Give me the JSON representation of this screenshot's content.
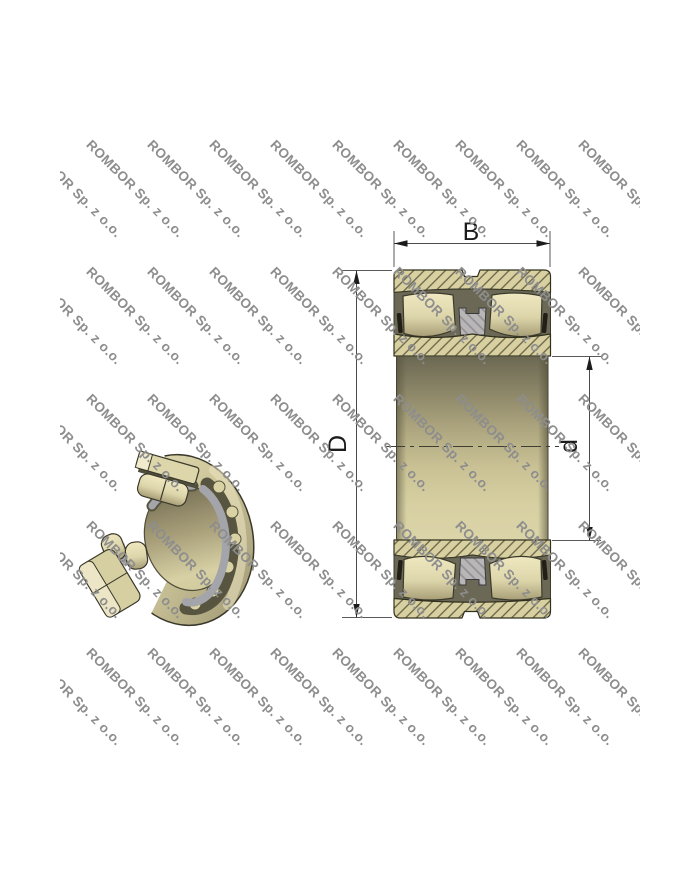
{
  "watermark": {
    "text": "ROMBOR Sp. z o.o.",
    "color": "#8d8d8d",
    "rows": 5,
    "cols": 10
  },
  "section": {
    "dim_labels": {
      "width": "B",
      "outer_diameter": "D",
      "bore_diameter": "d"
    }
  },
  "colors": {
    "background": "#ffffff",
    "bearing_khaki": "#d8d0a0",
    "cavity_dark": "#6b6956",
    "outline_dark": "#3a3828",
    "cage_gray": "#b9b6b8",
    "dimension_line": "#4a4a4a",
    "watermark_gray": "#8d8d8d"
  }
}
